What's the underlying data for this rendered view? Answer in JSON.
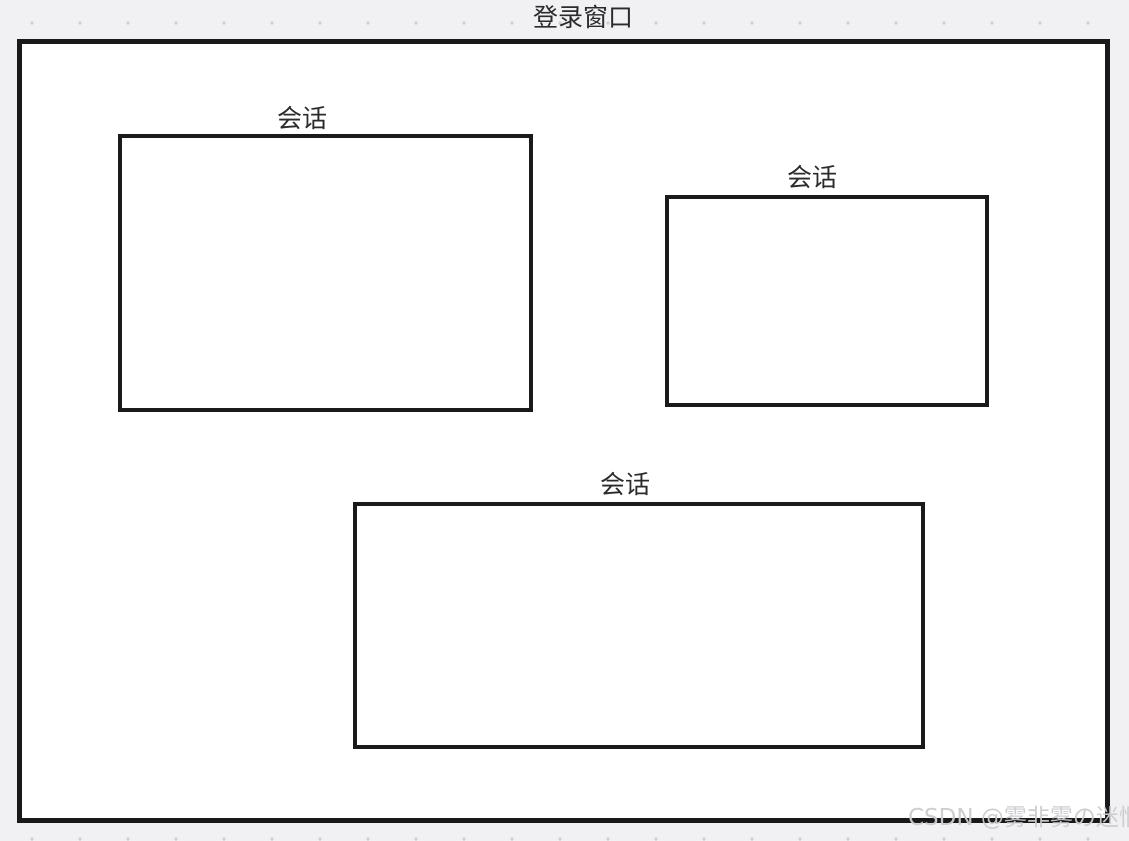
{
  "diagram": {
    "title": "登录窗口",
    "sessions": [
      {
        "label": "会话"
      },
      {
        "label": "会话"
      },
      {
        "label": "会话"
      }
    ]
  },
  "watermark": {
    "text": "CSDN @雾非雾の迷惘"
  },
  "colors": {
    "canvas_background": "#f1f1f4",
    "grid_dot": "#cfcfd3",
    "window_border": "#191919",
    "session_border": "#1a1a1a",
    "box_fill": "#ffffff",
    "label_text": "#2b2b2b",
    "watermark_text": "#cccccf"
  }
}
